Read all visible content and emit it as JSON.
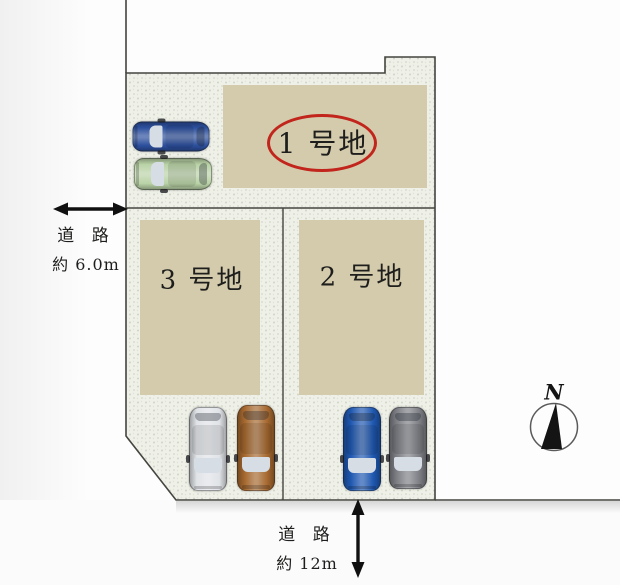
{
  "diagram": {
    "lots": [
      {
        "label": "1 号地",
        "highlighted": true
      },
      {
        "label": "2 号地",
        "highlighted": false
      },
      {
        "label": "3 号地",
        "highlighted": false
      }
    ],
    "road_left": {
      "name": "道  路",
      "width": "約 6.0m"
    },
    "road_bottom": {
      "name": "道  路",
      "width": "約 12m"
    },
    "compass": {
      "north_label": "N"
    }
  },
  "colors": {
    "ground": "#eff1e8",
    "speckle": "#c6cdbd",
    "lot_fill": "#d4cbad",
    "outline": "#45443f",
    "accent_red": "#c2251c",
    "text": "#1e1e1c",
    "windshield": "#d6dde4"
  },
  "cars": [
    {
      "name": "car-lot1-blue",
      "body": "#2c4f9d"
    },
    {
      "name": "car-lot1-green",
      "body": "#b9d2a6"
    },
    {
      "name": "car-lot3-silver",
      "body": "#e0e3e7"
    },
    {
      "name": "car-lot3-brown",
      "body": "#a5682f"
    },
    {
      "name": "car-lot2-blue",
      "body": "#1e57b0"
    },
    {
      "name": "car-lot2-grey",
      "body": "#7d7f85"
    }
  ]
}
